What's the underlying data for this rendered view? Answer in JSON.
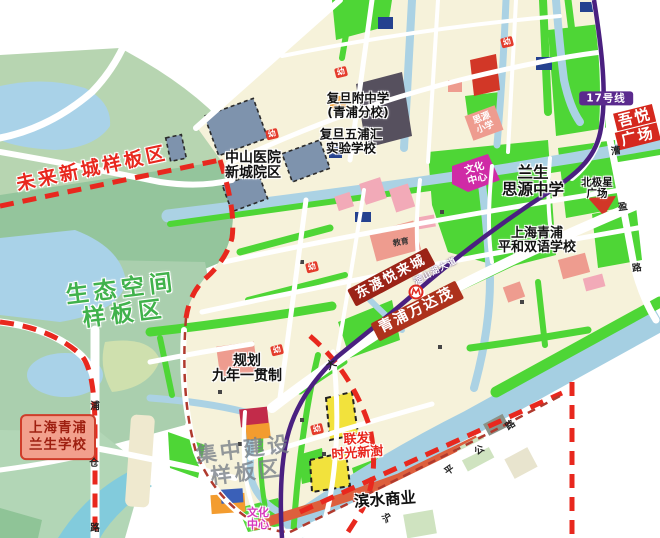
{
  "regions": {
    "future_city": "未来新城样板区",
    "eco_space": [
      "生态空间",
      "样板区"
    ],
    "concentrated": [
      "集中建设",
      "样板区"
    ]
  },
  "places": {
    "zhongshan_hospital": [
      "中山医院",
      "新城院区"
    ],
    "fudan_affiliated": [
      "复旦附中学",
      "(青浦分校)"
    ],
    "fudan_wupuhui": [
      "复旦五浦汇",
      "实验学校"
    ],
    "siyuan_primary": [
      "思源",
      "小学"
    ],
    "culture_center_north": [
      "文化",
      "中心"
    ],
    "lansheng_siyuan": [
      "兰生",
      "思源中学"
    ],
    "pinghe_school": [
      "上海青浦",
      "平和双语学校"
    ],
    "beijixing_plaza": [
      "北极星",
      "广场"
    ],
    "wuyue_plaza": [
      "吾悦",
      "广场"
    ],
    "planned_school": [
      "规划",
      "九年一贯制"
    ],
    "lansheng_school": [
      "上海青浦",
      "兰生学校"
    ],
    "dongdu_yuelai": "东渡悦来城",
    "wanda_mall": "青浦万达茂",
    "lianfa": [
      "联发",
      "时光新澍"
    ],
    "binshui_commercial": "滨水商业",
    "culture_center_south": [
      "文化",
      "中心"
    ],
    "education_tag": "教育",
    "kindergarten_tag": "幼"
  },
  "transit": {
    "line17_badge": "17号线"
  },
  "roads": {
    "dianshanhu_avenue": "淀山湖大道",
    "caoying_chars": [
      "漕",
      "盈",
      "路"
    ],
    "pucang_chars": [
      "浦",
      "仓",
      "路"
    ],
    "huqingping_chars": [
      "沪",
      "平",
      "公",
      "路"
    ],
    "avenue_char": "大"
  },
  "colors": {
    "boundary_red": "#e8281e",
    "metro_purple": "#4a2080",
    "park_green": "#4ed636",
    "water_blue": "#abd2e4",
    "city_cream": "#f6f2da",
    "label_strip_red": "#9b2317",
    "highlight_yellow": "#f2e23c"
  }
}
